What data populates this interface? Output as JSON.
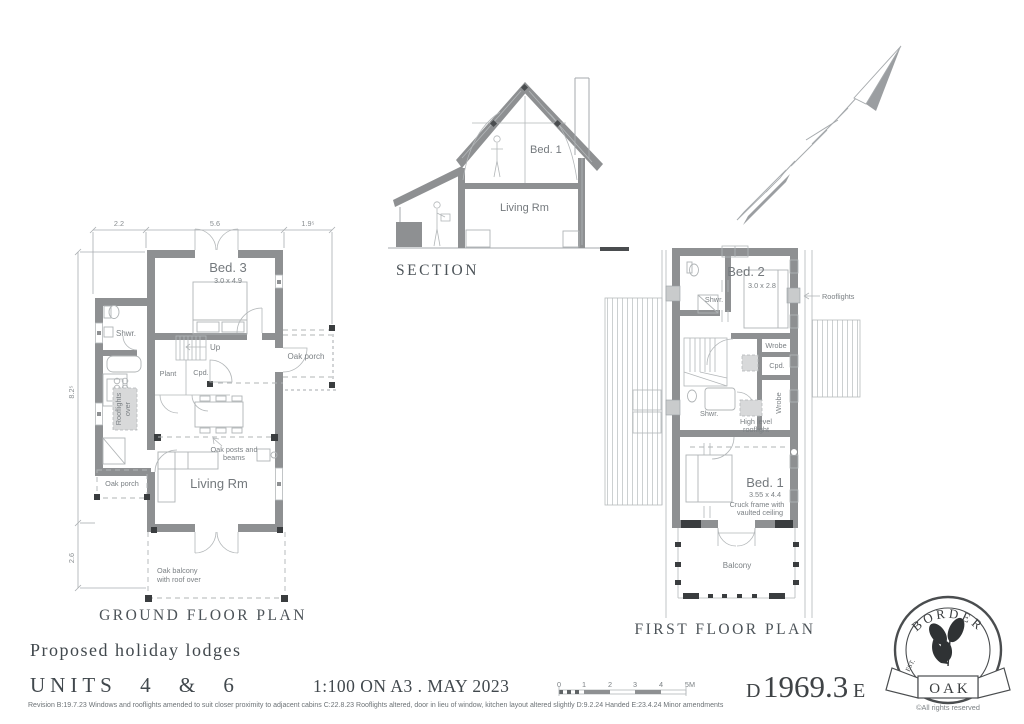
{
  "palette": {
    "wall": "#8e9092",
    "dark": "#3a3d3f",
    "line": "#a6aaad",
    "text": "#7b8084",
    "title": "#4c5358",
    "shade": "#d8d9da"
  },
  "section": {
    "title": "SECTION",
    "bed1": "Bed. 1",
    "living": "Living Rm"
  },
  "ground_floor": {
    "title": "GROUND FLOOR PLAN",
    "dim_top_1": "2.2",
    "dim_top_2": "5.6",
    "dim_top_3": "1.9⁵",
    "dim_left_1": "8.2⁵",
    "dim_left_2": "2.6",
    "bed3": "Bed. 3",
    "bed3_size": "3.0 x 4.9",
    "shwr": "Shwr.",
    "up": "Up",
    "plant": "Plant",
    "cpd": "Cpd.",
    "oak_porch_right": "Oak porch",
    "oak_porch_left": "Oak porch",
    "rooflights_over_1": "Rooflights",
    "rooflights_over_2": "over",
    "oak_posts_1": "Oak posts and",
    "oak_posts_2": "beams",
    "living": "Living Rm",
    "balcony_1": "Oak balcony",
    "balcony_2": "with roof over"
  },
  "first_floor": {
    "title": "FIRST FLOOR PLAN",
    "bed2": "Bed. 2",
    "bed2_size": "3.0 x 2.8",
    "shwr_top": "Shwr.",
    "rooflights": "Rooflights",
    "wrobe_top": "Wrobe",
    "cpd": "Cpd.",
    "wrobe_side": "Wrobe",
    "shwr_mid": "Shwr.",
    "high_level_1": "High level",
    "high_level_2": "rooflight",
    "bed1": "Bed. 1",
    "bed1_size": "3.55 x 4.4",
    "cruck_1": "Cruck frame with",
    "cruck_2": "vaulted ceiling",
    "balcony": "Balcony"
  },
  "title_block": {
    "project": "Proposed holiday lodges",
    "units": "UNITS 4 & 6",
    "scale_date": "1:100 ON A3 . MAY 2023",
    "revision": "Revision B:19.7.23 Windows and rooflights amended to suit closer proximity to adjacent cabins  C:22.8.23 Rooflights altered, door in lieu of window, kitchen layout altered slightly  D:9.2.24 Handed E:23.4.24 Minor amendments",
    "number_prefix": "D",
    "number": "1969.3",
    "number_suffix": "E"
  },
  "scale_bar": {
    "t0": "0",
    "t1": "1",
    "t2": "2",
    "t3": "3",
    "t4": "4",
    "unit": "5M"
  },
  "logo": {
    "arc": "BORDER",
    "banner": "OAK",
    "est": "EST.",
    "year": "1980",
    "rights": "©All rights reserved"
  }
}
